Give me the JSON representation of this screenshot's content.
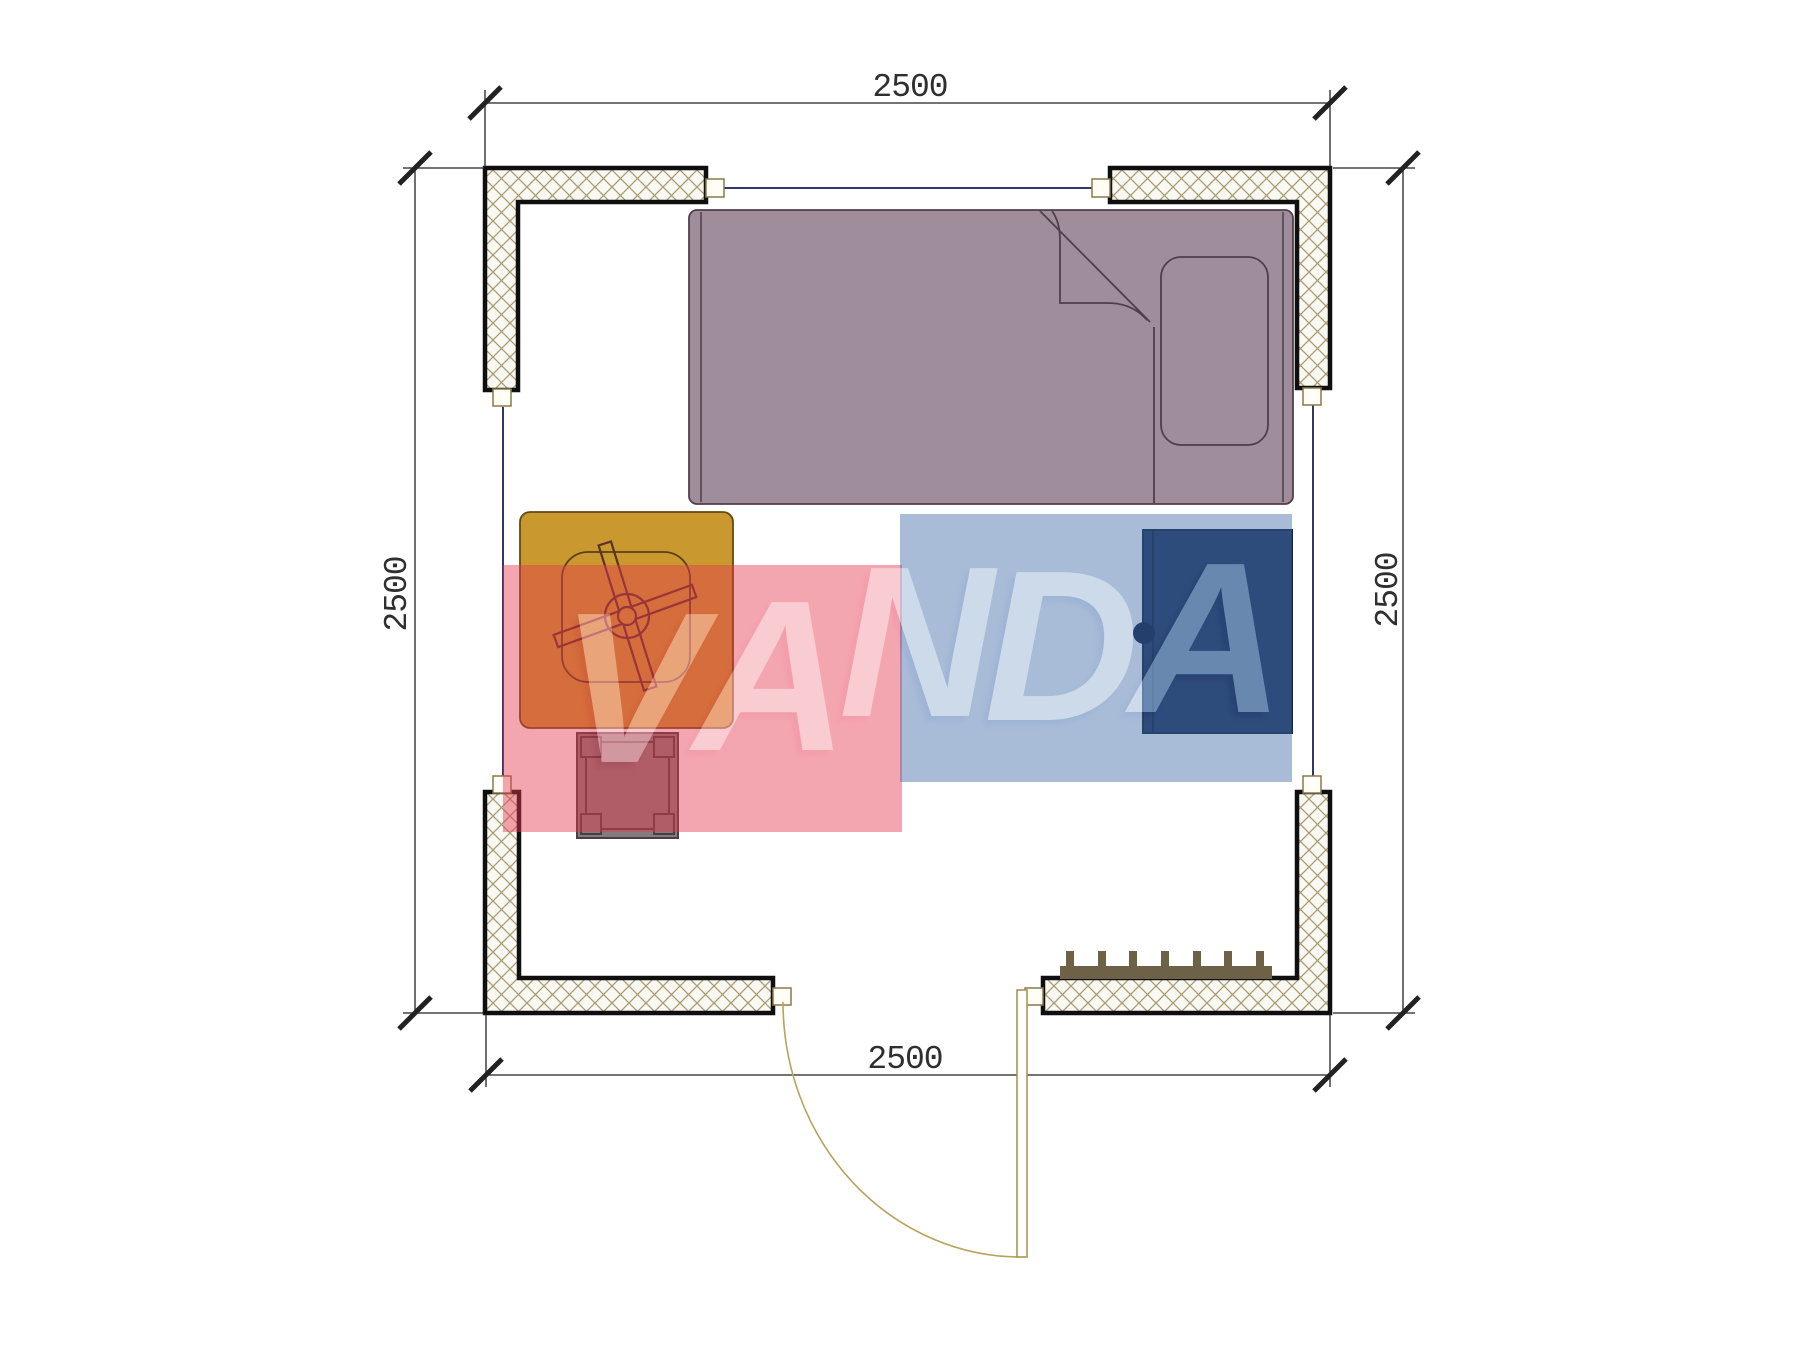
{
  "drawing": {
    "type": "floor-plan",
    "room": "bedroom 2.5 x 2.5 m"
  },
  "dimensions": {
    "top": {
      "label": "2500"
    },
    "bottom": {
      "label": "2500"
    },
    "left": {
      "label": "2500"
    },
    "right": {
      "label": "2500"
    }
  },
  "watermark": {
    "text": "VANDA",
    "letters": [
      "V",
      "A",
      "N",
      "D",
      "A"
    ],
    "red_fill": "rgba(231,58,80,0.45)",
    "blue_fill": "rgba(62,107,169,0.45)",
    "letter_color": "#ffffff"
  },
  "colors": {
    "wall_outline": "#0f0f0f",
    "wall_hatch": "#a79b72",
    "wall_fill": "#faf8f2",
    "window_line": "#32356e",
    "connector_outline": "#8a7948",
    "bed_fill": "#9f8d9b",
    "bed_outline": "#4f3f4c",
    "desk_fill": "#c9982e",
    "desk_outline": "#5f4a16",
    "fan_outline": "#5a3226",
    "stool_fill": "#837b7d",
    "stool_outline": "#4a3f41",
    "cabinet_fill": "#203256",
    "radiator_fill": "#6d6148",
    "door_line": "#b8a25c",
    "dimension_line": "#222222"
  }
}
